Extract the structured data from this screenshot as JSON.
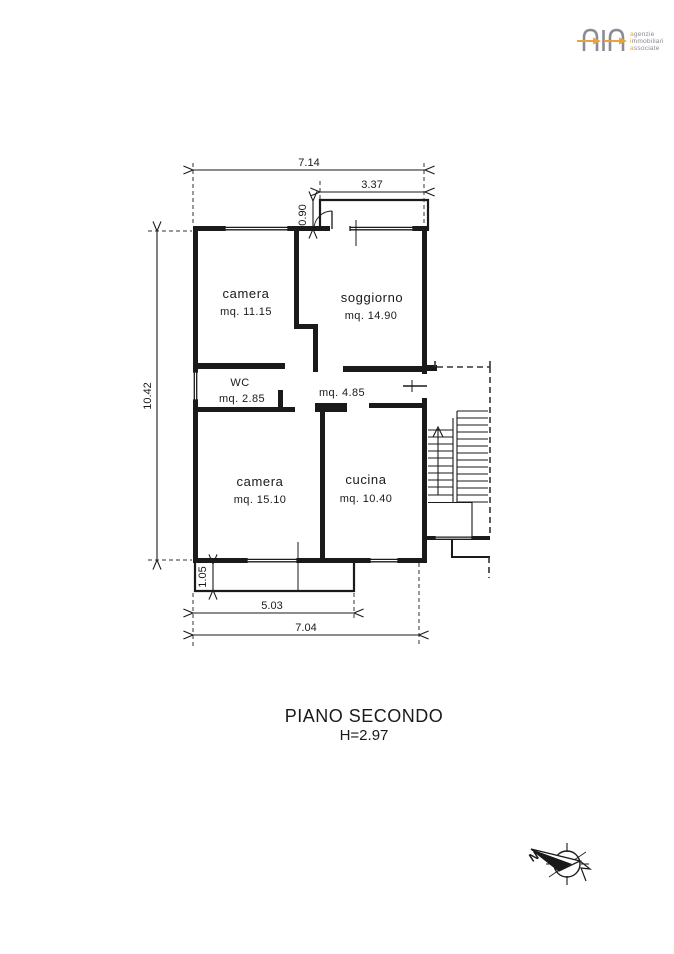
{
  "logo": {
    "initials": [
      "a",
      "i",
      "a"
    ],
    "rests": [
      "genzie",
      "mmobiliari",
      "ssociate"
    ],
    "gray": "#8b8b95",
    "orange": "#e8a33d"
  },
  "rooms": {
    "camera1": {
      "name": "camera",
      "area": "mq. 11.15"
    },
    "soggiorno": {
      "name": "soggiorno",
      "area": "mq. 14.90"
    },
    "wc": {
      "name": "WC",
      "area": "mq. 2.85"
    },
    "corridoio": {
      "area": "mq. 4.85"
    },
    "camera2": {
      "name": "camera",
      "area": "mq. 15.10"
    },
    "cucina": {
      "name": "cucina",
      "area": "mq. 10.40"
    }
  },
  "dimensions": {
    "width_top": "7.14",
    "balcony_top_width": "3.37",
    "balcony_top_depth": "0.90",
    "height_left": "10.42",
    "balcony_bottom_depth": "1.05",
    "balcony_bottom_width": "5.03",
    "width_bottom": "7.04"
  },
  "caption": {
    "floor": "PIANO SECONDO",
    "height": "H=2.97"
  },
  "compass": {
    "north": "N"
  },
  "line_color": "#1a1a1a"
}
